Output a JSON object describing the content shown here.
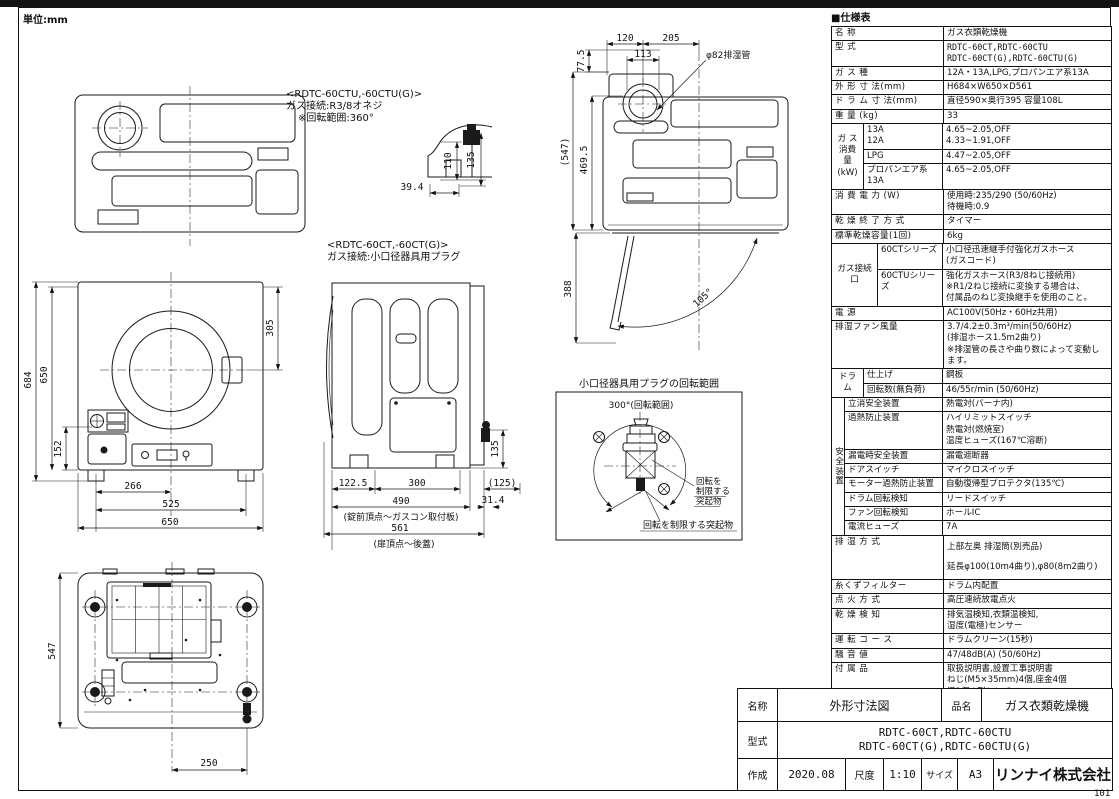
{
  "page": {
    "unit_label": "単位:mm",
    "page_number": "101",
    "footer_note": "※仕様は改良の為予告なく変更することがあります。"
  },
  "drawings": {
    "connector_detail": {
      "model_note": "<RDTC-60CTU,-60CTU(G)>",
      "gas_note": "ガス接続:R3/8オネジ",
      "rotation_note": "※回転範囲:360°",
      "dim_110": "110",
      "dim_135": "135",
      "dim_39_4": "39.4"
    },
    "front_view": {
      "dim_684": "684",
      "dim_650_height": "650",
      "dim_305": "305",
      "dim_152": "152",
      "dim_266": "266",
      "dim_525": "525",
      "dim_650_width": "650"
    },
    "side_view": {
      "model_note": "<RDTC-60CT,-60CT(G)>",
      "gas_note": "ガス接続:小口径器具用プラグ",
      "dim_122_5": "122.5",
      "dim_300": "300",
      "dim_125": "(125)",
      "dim_490": "490",
      "dim_490_label": "(錠前頂点〜ガスコン取付板)",
      "dim_561": "561",
      "dim_561_label": "(扉頂点〜後蓋)",
      "dim_135": "135",
      "dim_31_4": "31.4"
    },
    "open_view": {
      "dim_77_5": "77.5",
      "dim_120": "120",
      "dim_205": "205",
      "dim_113": "113",
      "exhaust_label": "φ82排湿管",
      "dim_547": "(547)",
      "dim_469_5": "469.5",
      "dim_388": "388",
      "dim_105": "105°"
    },
    "plug_diagram": {
      "title": "小口径器具用プラグの回転範囲",
      "range_label": "300°(回転範囲)",
      "limit_line1": "回転を",
      "limit_line2": "制限する",
      "limit_line3": "突起物",
      "limit_bottom": "回転を制限する突起物"
    },
    "bottom_view": {
      "dim_547": "547",
      "dim_250": "250"
    }
  },
  "spec_table": {
    "title": "■仕様表",
    "rows": [
      {
        "label": "名  称",
        "value": "ガス衣類乾燥機"
      },
      {
        "label": "型  式",
        "value": "RDTC-60CT,RDTC-60CTU\nRDTC-60CT(G),RDTC-60CTU(G)",
        "mono": true
      },
      {
        "label": "ガ ス 種",
        "value": "12A・13A,LPG,プロパンエア系13A"
      },
      {
        "label": "外 形 寸 法(mm)",
        "value": "H684×W650×D561"
      },
      {
        "label": "ド ラ ム 寸 法(mm)",
        "value": "直径590×奥行395 容量108L"
      },
      {
        "label": "重  量 (kg)",
        "value": "33"
      },
      {
        "group": "ガ ス\n消費量\n(kW)",
        "group_w": 32,
        "subs": [
          {
            "label": "13A\n12A",
            "value": "4.65~2.05,OFF\n4.33~1.91,OFF"
          },
          {
            "label": "LPG",
            "value": "4.47~2.05,OFF"
          },
          {
            "label": "プロパンエア系13A",
            "value": "4.65~2.05,OFF"
          }
        ]
      },
      {
        "label": "消 費 電 力 (W)",
        "value": "使用時:235/290 (50/60Hz)\n待機時:0.9"
      },
      {
        "label": "乾 燥 終 了 方 式",
        "value": "タイマー"
      },
      {
        "label": "標準乾燥容量(1回)",
        "value": "6kg"
      },
      {
        "group": "ガス接続口",
        "group_w": 46,
        "subs": [
          {
            "label": "60CTシリーズ",
            "value": "小口径迅速継手付強化ガスホース\n(ガスコード)"
          },
          {
            "label": "60CTUシリーズ",
            "value": "強化ガスホース(R3/8ねじ接続用)\n※R1/2ねじ接続に変換する場合は、\n 付属品のねじ変換継手を使用のこと。"
          }
        ]
      },
      {
        "label": "電  源",
        "value": "AC100V(50Hz・60Hz共用)"
      },
      {
        "label": "排湿ファン風量",
        "value": "3.7/4.2±0.3m³/min(50/60Hz)\n(排湿ホース1.5m2曲り)\n※排湿管の長さや曲り数によって変動します。"
      },
      {
        "group": "ドラム",
        "group_w": 32,
        "subs": [
          {
            "label": "仕上げ",
            "value": "鋼板"
          },
          {
            "label": "回転数(無負荷)",
            "value": "46/55r/min (50/60Hz)"
          }
        ]
      },
      {
        "group": "安全装置",
        "group_w": 13,
        "vertical": true,
        "subs": [
          {
            "label": "立消安全装置",
            "value": "熱電対(バーナ内)"
          },
          {
            "label": "過熱防止装置",
            "value": "ハイリミットスイッチ\n熱電対(燃焼室)\n温度ヒューズ(167℃溶断)"
          },
          {
            "label": "漏電時安全装置",
            "value": "漏電遮断器"
          },
          {
            "label": "ドアスイッチ",
            "value": "マイクロスイッチ"
          },
          {
            "label": "モーター過熱防止装置",
            "value": "自動復帰型プロテクタ(135℃)"
          },
          {
            "label": "ドラム回転検知",
            "value": "リードスイッチ"
          },
          {
            "label": "ファン回転検知",
            "value": "ホールIC"
          },
          {
            "label": "電流ヒューズ",
            "value": "7A"
          }
        ]
      },
      {
        "label": "排 湿 方 式",
        "value": "上部左奥 排湿筒(別売品)\n延長φ100(10m4曲り),φ80(8m2曲り)",
        "gap": true
      },
      {
        "label": "糸くずフィルター",
        "value": "ドラム内配置"
      },
      {
        "label": "点 火 方 式",
        "value": "高圧連続放電点火"
      },
      {
        "label": "乾 燥 検 知",
        "value": "排気温検知,衣類温検知,\n湿度(電極)センサー"
      },
      {
        "label": "運 転 コ ー ス",
        "value": "ドラムクリーン(15秒)"
      },
      {
        "label": "騒 音 値",
        "value": "47/48dB(A) (50/60Hz)"
      },
      {
        "label": "付 属 品",
        "value": "取扱説明書,設置工事説明書\nねじ(M5×35mm)4個,座金4個\n鍵2個,L型レンチ\n乾燥時間表示プレート\n※60CTUシリーズのみ\n ねじ変換継手\n (R3/8→R1/2ねじ接続変換用)"
      },
      {
        "label": "別 売 品",
        "value": "専用台(高・中・低),本体保護カバー,排湿トップ\n小物乾燥棚,デリケート袋",
        "small": true
      }
    ]
  },
  "title_block": {
    "name_label": "名称",
    "name_value": "外形寸法図",
    "product_label": "品名",
    "product_value": "ガス衣類乾燥機",
    "model_label": "型式",
    "model_value": "RDTC-60CT,RDTC-60CTU\nRDTC-60CT(G),RDTC-60CTU(G)",
    "date_label": "作成",
    "date_value": "2020.08",
    "scale_label": "尺度",
    "scale_value": "1:10",
    "size_label": "サイズ",
    "size_value": "A3",
    "company": "リンナイ株式会社"
  }
}
